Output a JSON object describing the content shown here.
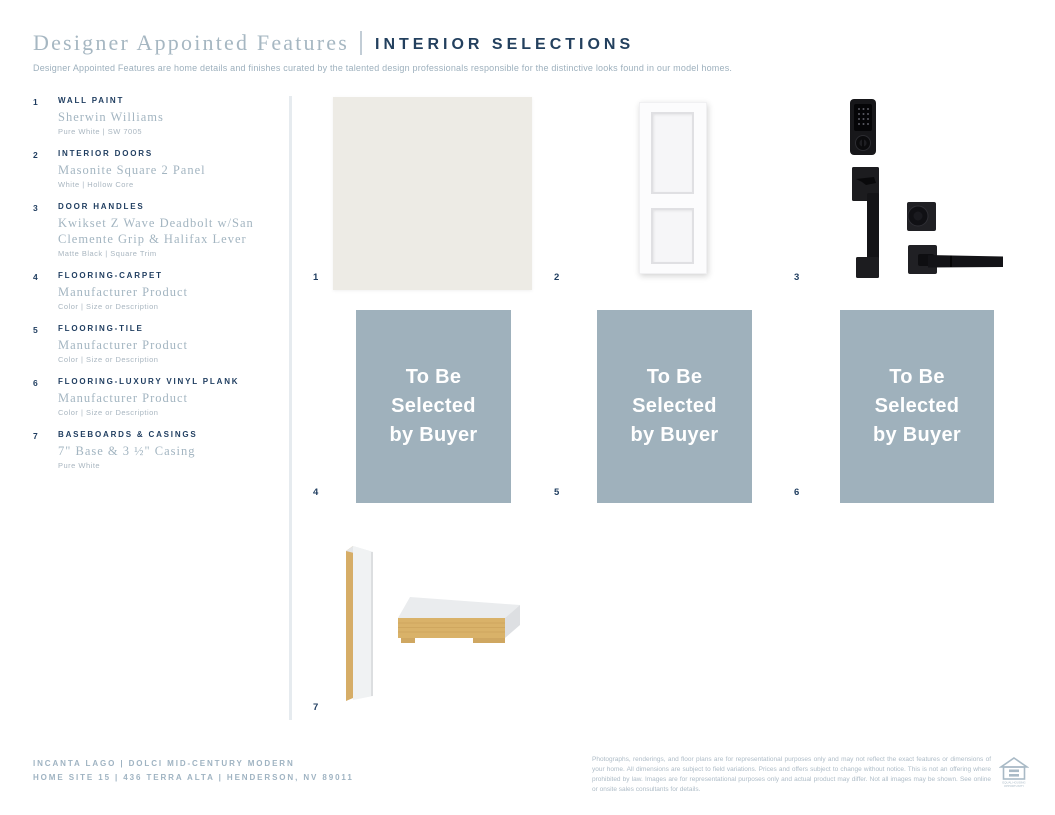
{
  "header": {
    "title_serif": "Designer Appointed Features",
    "title_caps": "INTERIOR SELECTIONS",
    "subtitle": "Designer Appointed Features are home details and finishes curated by the talented design professionals responsible for the distinctive looks found in our model homes."
  },
  "features": [
    {
      "num": "1",
      "heading": "WALL PAINT",
      "name": "Sherwin Williams",
      "detail": "Pure White  |  SW 7005"
    },
    {
      "num": "2",
      "heading": "INTERIOR DOORS",
      "name": "Masonite Square 2 Panel",
      "detail": "White  |  Hollow Core"
    },
    {
      "num": "3",
      "heading": "DOOR HANDLES",
      "name": "Kwikset Z Wave Deadbolt w/San Clemente Grip & Halifax Lever",
      "detail": "Matte Black  |  Square Trim"
    },
    {
      "num": "4",
      "heading": "FLOORING-CARPET",
      "name": "Manufacturer Product",
      "detail": "Color  |  Size or Description"
    },
    {
      "num": "5",
      "heading": "FLOORING-TILE",
      "name": "Manufacturer Product",
      "detail": "Color  |  Size or Description"
    },
    {
      "num": "6",
      "heading": "FLOORING-LUXURY VINYL PLANK",
      "name": "Manufacturer Product",
      "detail": "Color  |  Size or Description"
    },
    {
      "num": "7",
      "heading": "BASEBOARDS & CASINGS",
      "name": "7\" Base & 3 ½\" Casing",
      "detail": "Pure White"
    }
  ],
  "gallery": {
    "placeholder_lines": [
      "To Be",
      "Selected",
      "by Buyer"
    ],
    "numbers": [
      "1",
      "2",
      "3",
      "4",
      "5",
      "6",
      "7"
    ]
  },
  "footer": {
    "community_line": "INCANTA LAGO  |  DOLCI MID-CENTURY MODERN",
    "address_line": "HOME SITE 15  |  436 TERRA ALTA  |  HENDERSON, NV 89011",
    "disclaimer": "Photographs, renderings, and floor plans are for representational purposes only and may not reflect the exact features or dimensions of your home. All dimensions are subject to field variations. Prices and offers subject to change without notice. This is not an offering where prohibited by law. Images are for representational purposes only and actual product may differ. Not all images may be shown. See online or onsite sales consultants for details.",
    "logo_line1": "EQUAL HOUSING",
    "logo_line2": "OPPORTUNITY"
  },
  "colors": {
    "navy": "#1e3c5f",
    "muted_serif_blue": "#a3b5c1",
    "detail_gray": "#a9b6c0",
    "placeholder_box": "#9fb1bc",
    "paint_swatch": "#edebe5",
    "wood_tan": "#d9b269",
    "footer_text": "#9fb3c2",
    "disclaimer_text": "#aebcc7",
    "divider": "#e6ebef"
  }
}
